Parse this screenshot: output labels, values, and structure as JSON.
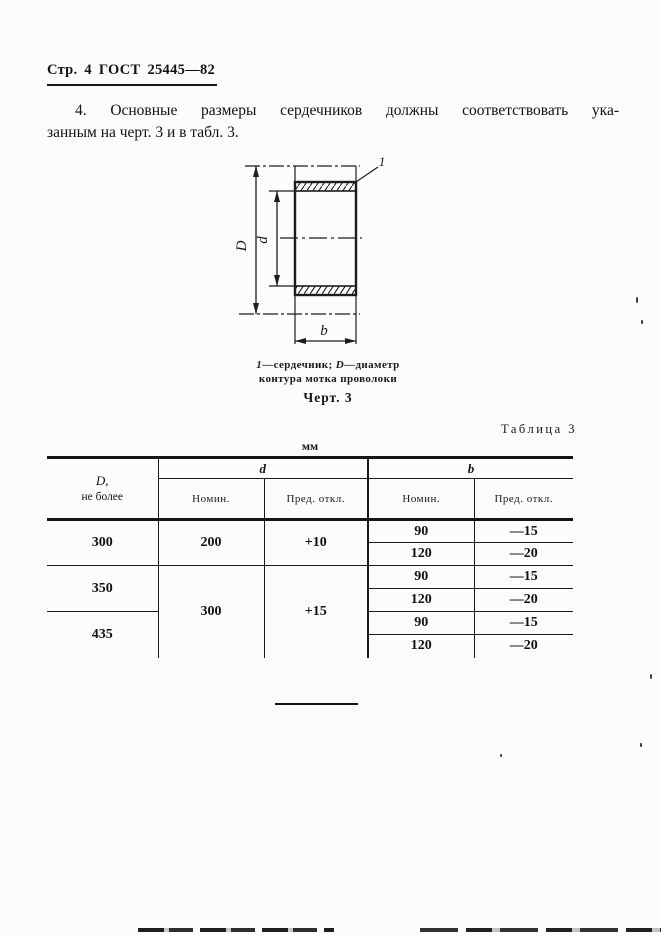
{
  "colors": {
    "paper": "#fcfcfa",
    "ink": "#141414"
  },
  "page_header": {
    "text": "Стр. 4  ГОСТ 25445—82"
  },
  "paragraph": {
    "line1": "4. Основные размеры сердечников должны соответствовать ука-",
    "line2": "занным на черт. 3 и в табл. 3."
  },
  "figure": {
    "dim_outer": "D",
    "dim_inner": "d",
    "dim_width": "b",
    "part_ref": "1",
    "caption": {
      "ref": "1",
      "ref_text": "—сердечник; ",
      "dim": "D",
      "dim_text": "—диаметр",
      "line2": "контура мотка проволоки"
    },
    "title": "Черт. 3"
  },
  "table": {
    "label": "Таблица 3",
    "units": "мм",
    "headers": {
      "col_D_line1": "D,",
      "col_D_line2": "не более",
      "group_d": "d",
      "group_b": "b",
      "nominal": "Номин.",
      "deviation": "Пред. откл."
    },
    "rows": [
      {
        "D": "300",
        "d_nom": "200",
        "d_dev": "+10",
        "b_nom": "90",
        "b_dev": "—15"
      },
      {
        "b_nom": "120",
        "b_dev": "—20"
      },
      {
        "D": "350",
        "d_nom": "300",
        "d_dev": "+15",
        "b_nom": "90",
        "b_dev": "—15"
      },
      {
        "b_nom": "120",
        "b_dev": "—20"
      },
      {
        "D": "435",
        "b_nom": "90",
        "b_dev": "—15"
      },
      {
        "b_nom": "120",
        "b_dev": "—20"
      }
    ]
  }
}
